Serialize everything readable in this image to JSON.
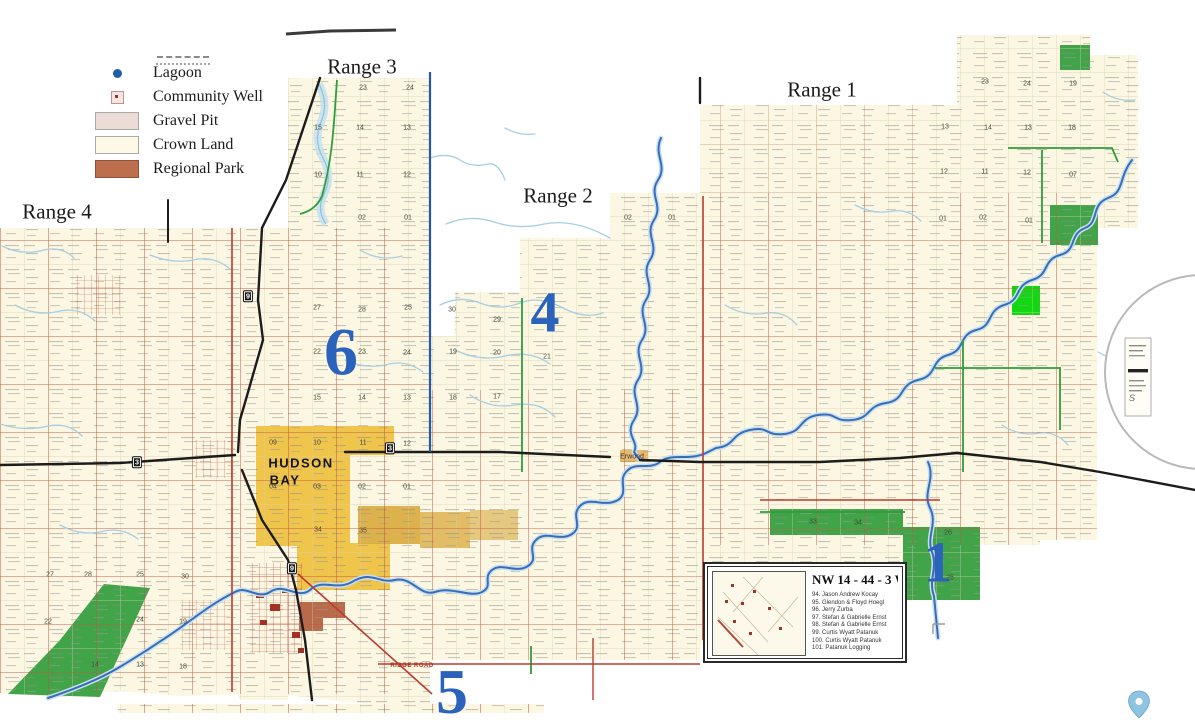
{
  "title": "Hudson Bay area rural municipality land ownership map",
  "colors": {
    "crown_land": "#fbf7e2",
    "grid_line": "#d6cfad",
    "road_red": "#bb3b2d",
    "road_green": "#2e9e3a",
    "highway_black": "#1c1c1c",
    "river_blue": "#3a6db5",
    "creek_blue": "#a7cee3",
    "range_line_blue": "#2458a8",
    "town_yellow": "#f0c54c",
    "mustard": "#d9a93c",
    "regional_park_brown": "#b96a4b",
    "parcel_green": "#41a449",
    "parcel_green_bright": "#12d812",
    "township_number_blue": "#2a62bc",
    "gravel_pit_pink": "#ecdcd6",
    "pin_blue": "#8ec3e2"
  },
  "legend": {
    "items": [
      {
        "label": "Lagoon"
      },
      {
        "label": "Community Well"
      },
      {
        "label": "Gravel Pit"
      },
      {
        "label": "Crown Land"
      },
      {
        "label": "Regional Park"
      }
    ]
  },
  "inset": {
    "title": "NW 14 - 44 - 3 W2",
    "owners": [
      "94.   Jason Andrew Kocay",
      "95.   Glendon & Floyd Hoegl",
      "96.   Jerry Zurba",
      "97.   Stefan & Gabrielle Ernst",
      "98.   Stefan & Gabrielle Ernst",
      "99.   Curtis Wyatt Patanuk",
      "100. Curtis Wyatt Patanuk",
      "101. Patanuk Logging"
    ]
  },
  "map_labels": [
    {
      "t": "Range 3",
      "x": 362,
      "y": 67,
      "c": "range"
    },
    {
      "t": "Range 1",
      "x": 822,
      "y": 90,
      "c": "range"
    },
    {
      "t": "Range 2",
      "x": 558,
      "y": 196,
      "c": "range"
    },
    {
      "t": "Range 4",
      "x": 57,
      "y": 212,
      "c": "range"
    },
    {
      "t": "6",
      "x": 341,
      "y": 352,
      "c": "bignum",
      "s": 68
    },
    {
      "t": "4",
      "x": 545,
      "y": 312,
      "c": "bignum",
      "s": 58
    },
    {
      "t": "1",
      "x": 938,
      "y": 562,
      "c": "bignum",
      "s": 58
    },
    {
      "t": "5",
      "x": 452,
      "y": 692,
      "c": "bignum",
      "s": 64
    },
    {
      "t": "HUDSON",
      "x": 301,
      "y": 463,
      "c": "town"
    },
    {
      "t": "BAY",
      "x": 285,
      "y": 480,
      "c": "town"
    },
    {
      "t": "Erwood",
      "x": 632,
      "y": 457,
      "c": "village"
    },
    {
      "t": "RIDGE ROAD",
      "x": 412,
      "y": 666,
      "c": "roadname"
    },
    {
      "t": "S",
      "x": 1132,
      "y": 398,
      "c": "tiny"
    },
    {
      "t": "9",
      "x": 248,
      "y": 296,
      "c": "shield"
    },
    {
      "t": "3",
      "x": 137,
      "y": 462,
      "c": "shield"
    },
    {
      "t": "3",
      "x": 390,
      "y": 448,
      "c": "shield"
    },
    {
      "t": "9",
      "x": 292,
      "y": 568,
      "c": "shield"
    },
    {
      "t": "23",
      "x": 363,
      "y": 88,
      "c": "sec"
    },
    {
      "t": "24",
      "x": 410,
      "y": 88,
      "c": "sec"
    },
    {
      "t": "15",
      "x": 318,
      "y": 128,
      "c": "sec"
    },
    {
      "t": "14",
      "x": 360,
      "y": 128,
      "c": "sec"
    },
    {
      "t": "13",
      "x": 407,
      "y": 128,
      "c": "sec"
    },
    {
      "t": "10",
      "x": 318,
      "y": 175,
      "c": "sec"
    },
    {
      "t": "11",
      "x": 360,
      "y": 175,
      "c": "sec"
    },
    {
      "t": "12",
      "x": 407,
      "y": 175,
      "c": "sec"
    },
    {
      "t": "02",
      "x": 362,
      "y": 218,
      "c": "sec"
    },
    {
      "t": "01",
      "x": 408,
      "y": 218,
      "c": "sec"
    },
    {
      "t": "27",
      "x": 317,
      "y": 308,
      "c": "sec"
    },
    {
      "t": "28",
      "x": 362,
      "y": 310,
      "c": "sec"
    },
    {
      "t": "25",
      "x": 408,
      "y": 308,
      "c": "sec"
    },
    {
      "t": "30",
      "x": 452,
      "y": 310,
      "c": "sec"
    },
    {
      "t": "29",
      "x": 497,
      "y": 320,
      "c": "sec"
    },
    {
      "t": "22",
      "x": 317,
      "y": 352,
      "c": "sec"
    },
    {
      "t": "23",
      "x": 362,
      "y": 352,
      "c": "sec"
    },
    {
      "t": "24",
      "x": 407,
      "y": 353,
      "c": "sec"
    },
    {
      "t": "19",
      "x": 453,
      "y": 352,
      "c": "sec"
    },
    {
      "t": "20",
      "x": 497,
      "y": 353,
      "c": "sec"
    },
    {
      "t": "21",
      "x": 547,
      "y": 357,
      "c": "sec"
    },
    {
      "t": "15",
      "x": 317,
      "y": 398,
      "c": "sec"
    },
    {
      "t": "14",
      "x": 362,
      "y": 398,
      "c": "sec"
    },
    {
      "t": "13",
      "x": 407,
      "y": 398,
      "c": "sec"
    },
    {
      "t": "18",
      "x": 453,
      "y": 398,
      "c": "sec"
    },
    {
      "t": "17",
      "x": 497,
      "y": 397,
      "c": "sec"
    },
    {
      "t": "09",
      "x": 273,
      "y": 443,
      "c": "sec"
    },
    {
      "t": "10",
      "x": 317,
      "y": 443,
      "c": "sec"
    },
    {
      "t": "11",
      "x": 363,
      "y": 443,
      "c": "sec"
    },
    {
      "t": "12",
      "x": 407,
      "y": 444,
      "c": "sec"
    },
    {
      "t": "04",
      "x": 273,
      "y": 487,
      "c": "sec"
    },
    {
      "t": "03",
      "x": 317,
      "y": 487,
      "c": "sec"
    },
    {
      "t": "02",
      "x": 362,
      "y": 487,
      "c": "sec"
    },
    {
      "t": "01",
      "x": 407,
      "y": 487,
      "c": "sec"
    },
    {
      "t": "34",
      "x": 318,
      "y": 530,
      "c": "sec"
    },
    {
      "t": "35",
      "x": 363,
      "y": 531,
      "c": "sec"
    },
    {
      "t": "02",
      "x": 628,
      "y": 218,
      "c": "sec"
    },
    {
      "t": "01",
      "x": 672,
      "y": 218,
      "c": "sec"
    },
    {
      "t": "23",
      "x": 985,
      "y": 82,
      "c": "sec"
    },
    {
      "t": "24",
      "x": 1027,
      "y": 84,
      "c": "sec"
    },
    {
      "t": "19",
      "x": 1073,
      "y": 84,
      "c": "sec"
    },
    {
      "t": "13",
      "x": 945,
      "y": 127,
      "c": "sec"
    },
    {
      "t": "14",
      "x": 988,
      "y": 128,
      "c": "sec"
    },
    {
      "t": "13",
      "x": 1028,
      "y": 128,
      "c": "sec"
    },
    {
      "t": "18",
      "x": 1072,
      "y": 128,
      "c": "sec"
    },
    {
      "t": "12",
      "x": 944,
      "y": 172,
      "c": "sec"
    },
    {
      "t": "11",
      "x": 985,
      "y": 172,
      "c": "sec"
    },
    {
      "t": "12",
      "x": 1027,
      "y": 173,
      "c": "sec"
    },
    {
      "t": "07",
      "x": 1073,
      "y": 175,
      "c": "sec"
    },
    {
      "t": "01",
      "x": 943,
      "y": 219,
      "c": "sec"
    },
    {
      "t": "02",
      "x": 983,
      "y": 218,
      "c": "sec"
    },
    {
      "t": "01",
      "x": 1029,
      "y": 221,
      "c": "sec"
    },
    {
      "t": "27",
      "x": 50,
      "y": 575,
      "c": "sec"
    },
    {
      "t": "28",
      "x": 88,
      "y": 575,
      "c": "sec"
    },
    {
      "t": "25",
      "x": 140,
      "y": 575,
      "c": "sec"
    },
    {
      "t": "30",
      "x": 185,
      "y": 577,
      "c": "sec"
    },
    {
      "t": "22",
      "x": 48,
      "y": 622,
      "c": "sec"
    },
    {
      "t": "24",
      "x": 140,
      "y": 620,
      "c": "sec"
    },
    {
      "t": "19",
      "x": 183,
      "y": 622,
      "c": "sec"
    },
    {
      "t": "14",
      "x": 95,
      "y": 665,
      "c": "sec"
    },
    {
      "t": "13",
      "x": 140,
      "y": 665,
      "c": "sec"
    },
    {
      "t": "18",
      "x": 183,
      "y": 667,
      "c": "sec"
    },
    {
      "t": "33",
      "x": 813,
      "y": 522,
      "c": "sec"
    },
    {
      "t": "34",
      "x": 858,
      "y": 523,
      "c": "sec"
    },
    {
      "t": "26",
      "x": 948,
      "y": 533,
      "c": "sec"
    },
    {
      "t": "25",
      "x": 950,
      "y": 578,
      "c": "sec"
    }
  ]
}
